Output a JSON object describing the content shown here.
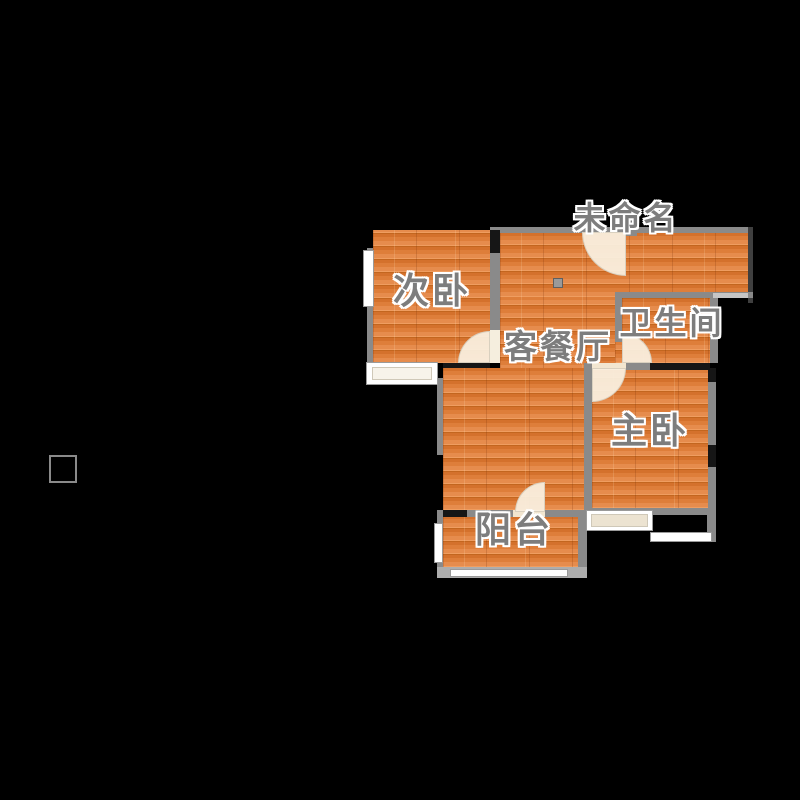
{
  "plan": {
    "type": "apartment-floor-plan",
    "background_color": "#000000",
    "palette": {
      "floor_wood": "#df8040",
      "wall_gray": "#8a8a8a",
      "wall_black": "#161616",
      "window_white": "#ffffff",
      "door_arc": "#f9eedd",
      "label_gray": "#7d7d7d",
      "label_outline": "#ffffff"
    },
    "rooms": {
      "unnamed": {
        "label": "未命名"
      },
      "second_bedroom": {
        "label": "次卧"
      },
      "bathroom": {
        "label": "卫生间"
      },
      "living_dining": {
        "label": "客餐厅"
      },
      "master_bedroom": {
        "label": "主卧"
      },
      "balcony": {
        "label": "阳台"
      }
    }
  }
}
